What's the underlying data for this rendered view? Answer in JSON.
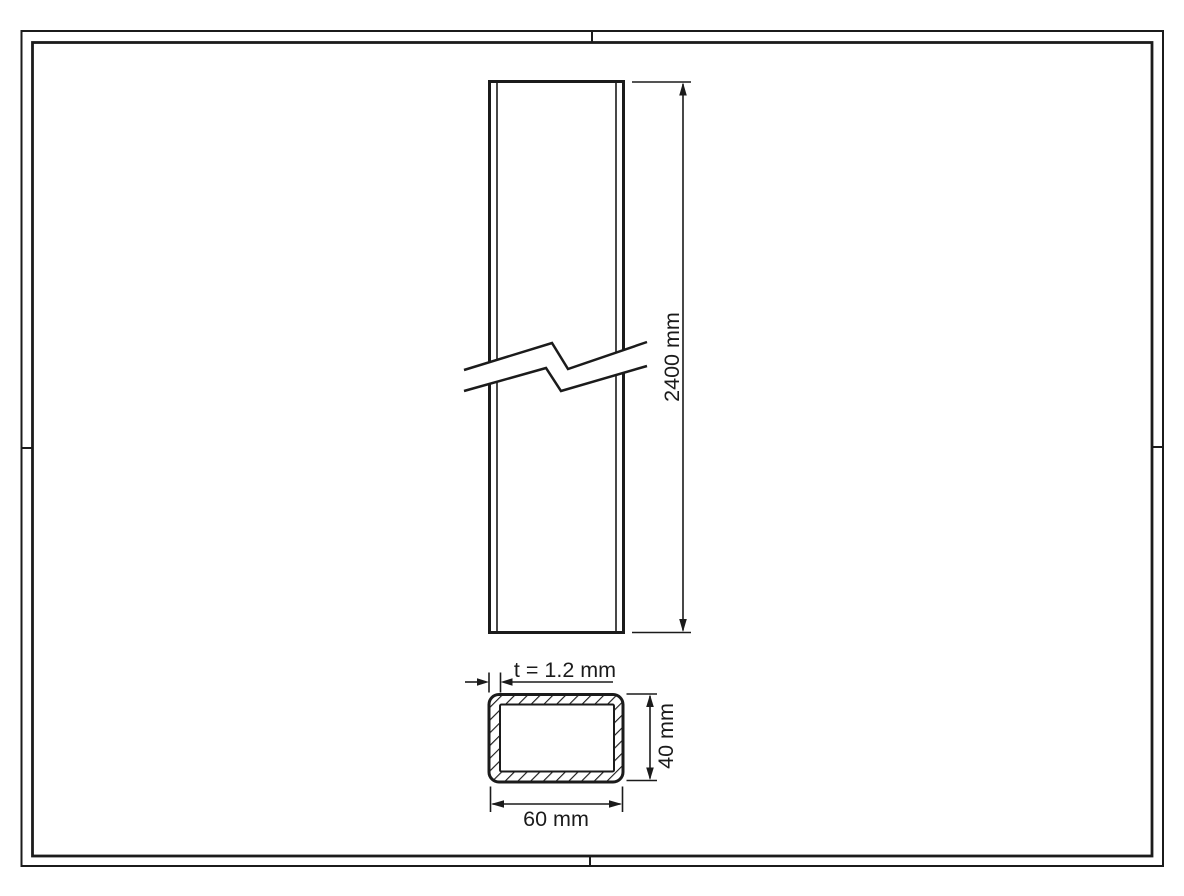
{
  "sheet": {
    "background_color": "#ffffff",
    "line_color": "#1b1b1b"
  },
  "labels": {
    "length": "2400 mm",
    "wall_thickness": "t = 1.2 mm",
    "profile_height": "40 mm",
    "profile_width": "60 mm"
  }
}
